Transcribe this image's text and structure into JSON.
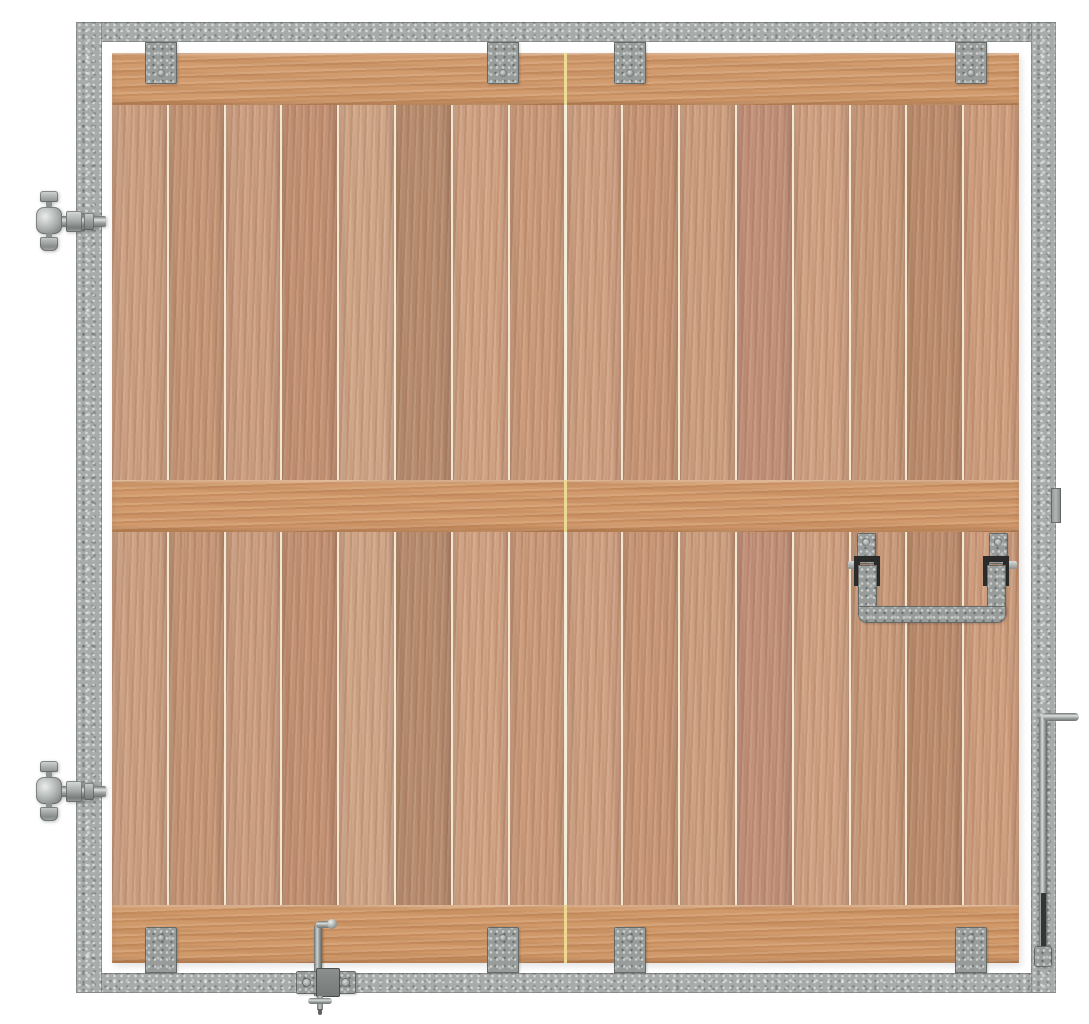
{
  "scene": {
    "subject": "timber-stable-door-with-galvanized-steel-frame",
    "background": "#ffffff"
  },
  "palette": {
    "frame_base": "#a7aba9",
    "frame_speckle_light": "#cdd1cf",
    "frame_speckle_dark": "#6e7371",
    "bracket_base": "#989d9b",
    "wood_rail": "#d19b6e",
    "plank_gap": "#f1e8d4",
    "center_seam_on_rail": "#efdf96",
    "hardware_black": "#2b2b2b",
    "metal_highlight": "#dbdfdd"
  },
  "frame": {
    "rivets": {
      "left_x": 88,
      "right_x": 1043,
      "top_y": 29,
      "left_ys": [
        58,
        182,
        311,
        440,
        570,
        699,
        828,
        957
      ],
      "right_ys": [
        57,
        182,
        311,
        440,
        570,
        699,
        828,
        957
      ],
      "top_xs": [
        302,
        662,
        940
      ]
    }
  },
  "door": {
    "plank_count": 16,
    "plank_tints": [
      "#cda184",
      "#c69778",
      "#cc9f82",
      "#c39174",
      "#d0a689",
      "#b78c6f",
      "#d1a385",
      "#cb9b7c",
      "#cfa183",
      "#c89778",
      "#cda081",
      "#c2917a",
      "#d0a284",
      "#ca9c7d",
      "#bd8d6f",
      "#cf9f80"
    ],
    "rails": [
      "top",
      "middle",
      "bottom"
    ],
    "bracket_centers_x": [
      161,
      503,
      630,
      971
    ]
  },
  "hardware": {
    "hinges": {
      "count": 2,
      "centers_y": [
        222,
        792
      ]
    },
    "drop_handle": {
      "side": "right",
      "parts": [
        "left-plate",
        "right-plate",
        "left-clevis",
        "right-clevis",
        "u-bar"
      ]
    },
    "latch_keeper": {
      "side": "right-frame"
    },
    "right_drop_bolt": {
      "parts": [
        "l-handle",
        "rod",
        "guide-clip"
      ]
    },
    "bottom_drop_bolt": {
      "parts": [
        "l-handle",
        "rod",
        "guide-plate",
        "ground-pin"
      ]
    }
  }
}
